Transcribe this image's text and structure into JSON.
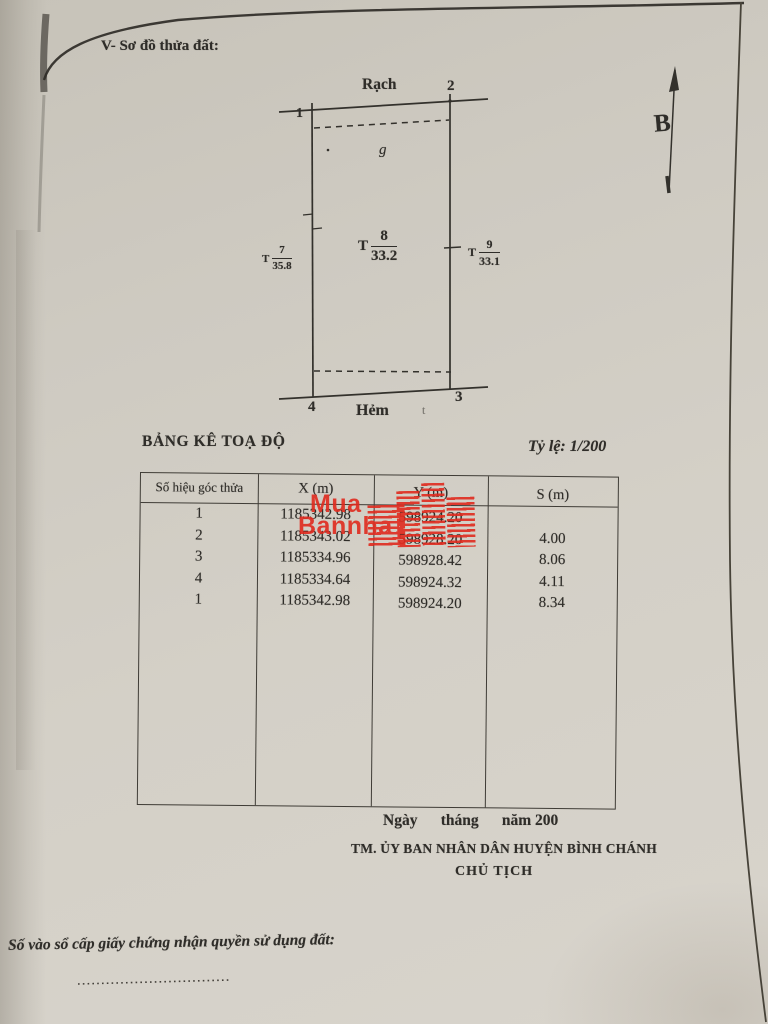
{
  "page": {
    "section_heading": "V- Sơ đồ thửa đất:",
    "table_title": "BẢNG KÊ TOẠ ĐỘ",
    "scale_label": "Tỷ lệ: 1/200",
    "date_line": "Ngày      tháng      năm 200",
    "committee_line": "TM. ỦY BAN NHÂN DÂN HUYỆN BÌNH CHÁNH",
    "chairman_line": "CHỦ TỊCH",
    "registry_line": "Số vào sổ cấp giấy chứng nhận quyền sử dụng đất:"
  },
  "diagram": {
    "north_label": "B",
    "road_top": "Rạch",
    "road_bottom": "Hẻm",
    "corner_1": "1",
    "corner_2": "2",
    "corner_3": "3",
    "corner_4": "4",
    "inner_note": "g",
    "stray_mark": "t",
    "dim_left": {
      "prefix": "T",
      "num": "7",
      "den": "35.8"
    },
    "dim_center": {
      "prefix": "T",
      "num": "8",
      "den": "33.2"
    },
    "dim_right": {
      "prefix": "T",
      "num": "9",
      "den": "33.1"
    }
  },
  "table": {
    "headers": [
      "Số hiệu góc thửa",
      "X (m)",
      "Y (m)",
      "S (m)"
    ],
    "rows": [
      {
        "id": "1",
        "x": "1185342.98",
        "y": "598924.20",
        "s": ""
      },
      {
        "id": "2",
        "x": "1185343.02",
        "y": "598928.20",
        "s": "4.00"
      },
      {
        "id": "3",
        "x": "1185334.96",
        "y": "598928.42",
        "s": "8.06"
      },
      {
        "id": "4",
        "x": "1185334.64",
        "y": "598924.32",
        "s": "4.11"
      },
      {
        "id": "1",
        "x": "1185342.98",
        "y": "598924.20",
        "s": "8.34"
      }
    ]
  },
  "watermark": {
    "line1": "Mua",
    "line2": "Bannha",
    "color": "#e02a1e"
  },
  "colors": {
    "paper": "#d2cec5",
    "ink": "#2f2d29",
    "line": "#33312c"
  }
}
